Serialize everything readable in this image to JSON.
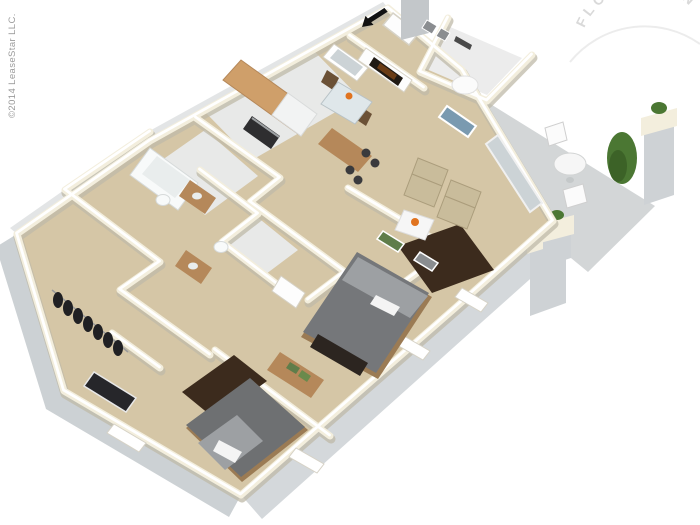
{
  "image": {
    "width": 700,
    "height": 525,
    "kind": "3d-isometric-floor-plan-rendering"
  },
  "watermark": {
    "text": "FLOOR PLAN"
  },
  "credit": {
    "text": "©2014 LeaseStar LLC."
  },
  "palette": {
    "bg": "#ffffff",
    "carpet": "#d5c6a6",
    "tile": "#e8e9e8",
    "patioSlab": "#d3d6d7",
    "wallTop": "#f3eedd",
    "wallShadow": "#bfb9a8",
    "wallCore": "#ffffff",
    "extFaceSW": "#ccd1d4",
    "extFaceSE": "#d4d8db",
    "extFaceNE": "#dde0e2",
    "extFaceNW": "#e3e5e6",
    "wood": "#b5885a",
    "woodLight": "#cf9f6a",
    "woodDark": "#9b7b54",
    "fridgeWhite": "#f2f3f3",
    "applianceDark": "#2e2e30",
    "glassBlue": "#ccd3d6",
    "rugBrown": "#3c2b1d",
    "duvetGray": "#75777a",
    "duvetGray2": "#6e7072",
    "pillowGray": "#9da0a3",
    "linenWhite": "#f4f4f4",
    "chairTan": "#c9bc9b",
    "chairTanEdge": "#ab9d7c",
    "tableWhite": "#f6f6f6",
    "flowerOrange": "#e0731f",
    "leafGreen": "#4b7733",
    "leafDark": "#3c6227",
    "clothesDark": "#202023",
    "benchDark": "#2c2520",
    "fireboxDark": "#201a14",
    "emberGlow": "#6a3c16",
    "chimneyGray": "#c3c7ca",
    "concrete": "#ced2d5",
    "fixtureWhite": "#f8fafa",
    "fixtureShade": "#e9eded",
    "artGreen": "#5f7d4a",
    "artBlue": "#7a9ab0",
    "frameGray": "#8a8d90",
    "stoolDark": "#3a3a3d",
    "arrowBlack": "#121212",
    "watermarkGray": "#d8d8d8",
    "creditGray": "#9a9a9a",
    "doorWhite": "#fdfdfd",
    "trimGray": "#d6d2c6"
  },
  "scene": {
    "style": "two-bedroom two-bath apartment, white walls with cream wall tops, tan carpet",
    "rooms": [
      "entry",
      "kitchen",
      "dining-area",
      "den",
      "living-room",
      "patio",
      "bathroom-1",
      "bathroom-2",
      "hall-closet",
      "bedroom-1",
      "bedroom-2"
    ],
    "furniture": [
      "kitchen-cabinets",
      "refrigerator",
      "range",
      "breakfast-bar",
      "bar-stools",
      "dining-table",
      "dining-chairs",
      "fireplace",
      "armchairs",
      "coffee-table",
      "area-rugs",
      "bed-1",
      "bed-2",
      "bench",
      "dresser",
      "bathtub",
      "vanity-sinks",
      "toilets",
      "hanging-clothes",
      "patio-table",
      "patio-chairs",
      "shrub",
      "planter-pillars"
    ],
    "entry_marker": "black-arrow"
  }
}
